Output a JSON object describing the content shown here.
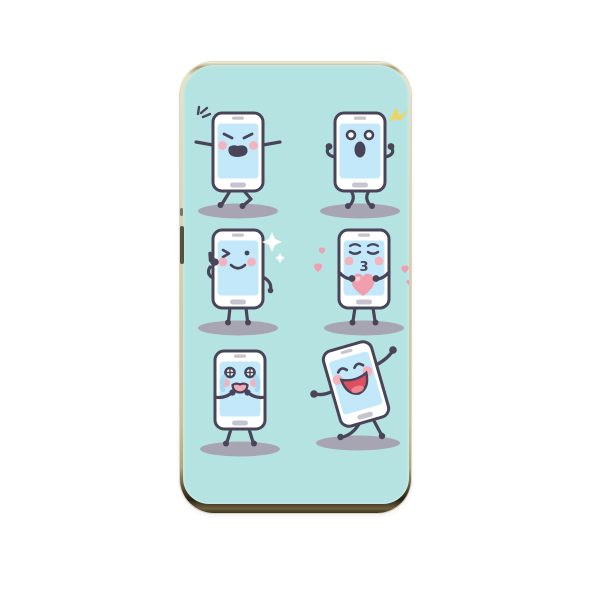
{
  "product": {
    "name": "phone-case",
    "surface_color": "#b5e3e1",
    "frame_color_top": "#d9d1ab",
    "frame_color_bottom": "#262013",
    "side_button": "volume-button"
  },
  "colors": {
    "outline": "#4a4458",
    "case-bg": "#b5e3e1",
    "screen": "#c2e8f9",
    "body": "#ffffff",
    "cheek": "#f3b3bd",
    "heart": "#f09fae",
    "heart-light": "#f8cad2",
    "tear": "#a5d8f1",
    "sparkle": "#efd35c",
    "shadow": "#a8a5b2",
    "hw": "#c6c4ce",
    "mouth-red": "#dd4f61",
    "tongue": "#f0838f"
  },
  "stickers": [
    {
      "name": "angry-phone-sticker",
      "emotion": "angry",
      "extras": [
        "anger-mark"
      ]
    },
    {
      "name": "surprised-phone-sticker",
      "emotion": "surprised",
      "extras": [
        "yellow-sparkle"
      ]
    },
    {
      "name": "winking-phone-sticker",
      "emotion": "wink-thumbs-up",
      "extras": [
        "white-sparkles"
      ]
    },
    {
      "name": "kissing-phone-sticker",
      "emotion": "blowing-kiss",
      "mouth_text": "3",
      "extras": [
        "big-heart",
        "floating-hearts"
      ]
    },
    {
      "name": "crying-phone-sticker",
      "emotion": "crying",
      "extras": [
        "tears"
      ]
    },
    {
      "name": "dancing-phone-sticker",
      "emotion": "laughing-dancing",
      "extras": []
    }
  ]
}
